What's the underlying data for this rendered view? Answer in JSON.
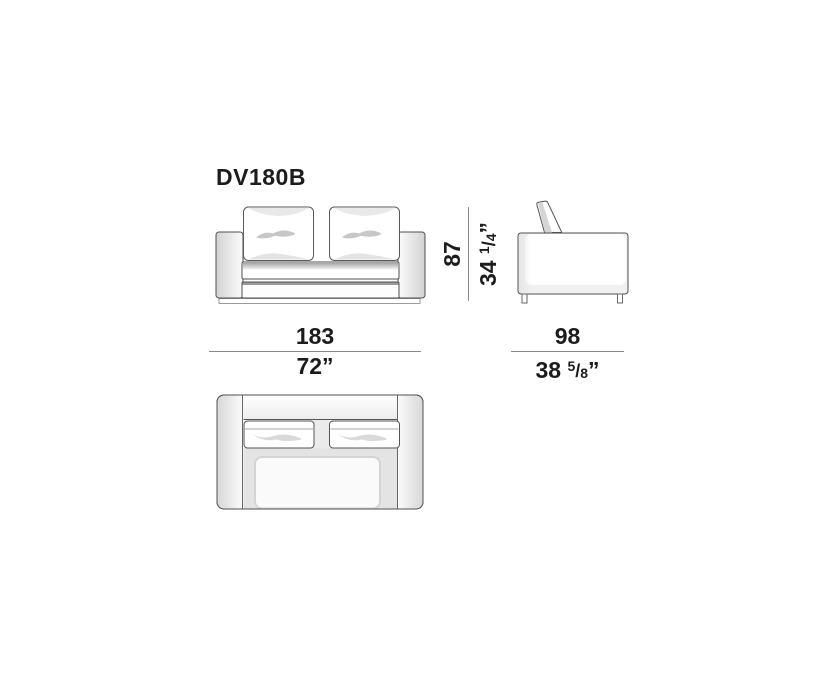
{
  "title": {
    "model": "DV180B"
  },
  "dimensions": {
    "width": {
      "cm": "183",
      "inches": "72”"
    },
    "depth": {
      "cm": "98",
      "inches_whole": "38",
      "frac_num": "5",
      "frac_sep": "/",
      "frac_den": "8",
      "unit": "”"
    },
    "height": {
      "cm": "87",
      "inches_whole": "34",
      "frac_num": "1",
      "frac_sep": "/",
      "frac_den": "4",
      "unit": "”"
    }
  },
  "colors": {
    "ink": "#1c1c1c",
    "drawing_outline": "#4f4f4f",
    "dimension_line": "#8a8a8a",
    "soft_shadow": "#c8c8c8",
    "background": "#ffffff"
  },
  "views": {
    "front": "front-elevation",
    "side": "side-elevation",
    "top": "plan-view"
  }
}
